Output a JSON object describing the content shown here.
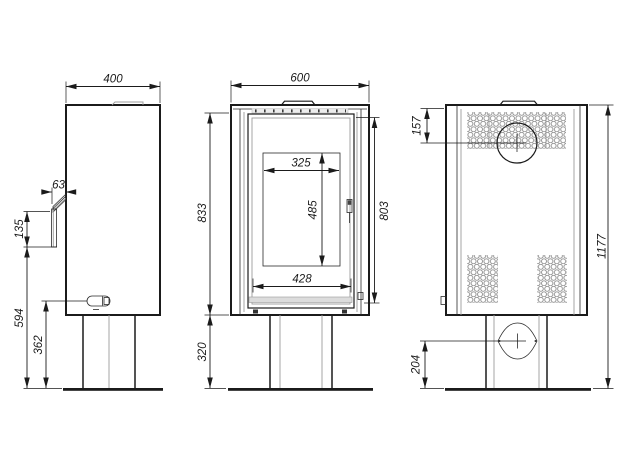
{
  "drawing": {
    "type": "technical-drawing",
    "subject": "freestanding stove three-view dimensional drawing",
    "colors": {
      "line": "#1b1b1b",
      "gray_line": "#9c9c9c",
      "perforation": "#8f8f8f",
      "hatch_band": "#dcdcdc",
      "background": "#ffffff"
    },
    "views": {
      "side": {
        "dims": {
          "width": "400",
          "handle_depth": "63",
          "handle_height": "135",
          "handle_to_floor": "594",
          "knob_to_floor": "362"
        }
      },
      "front": {
        "dims": {
          "width": "600",
          "body_height": "833",
          "door_height": "803",
          "glass_width": "325",
          "glass_height": "485",
          "opening_width": "428",
          "base_height": "320"
        }
      },
      "rear": {
        "dims": {
          "flue_offset_top": "157",
          "overall_height": "1177",
          "intake_height": "204"
        }
      }
    }
  }
}
